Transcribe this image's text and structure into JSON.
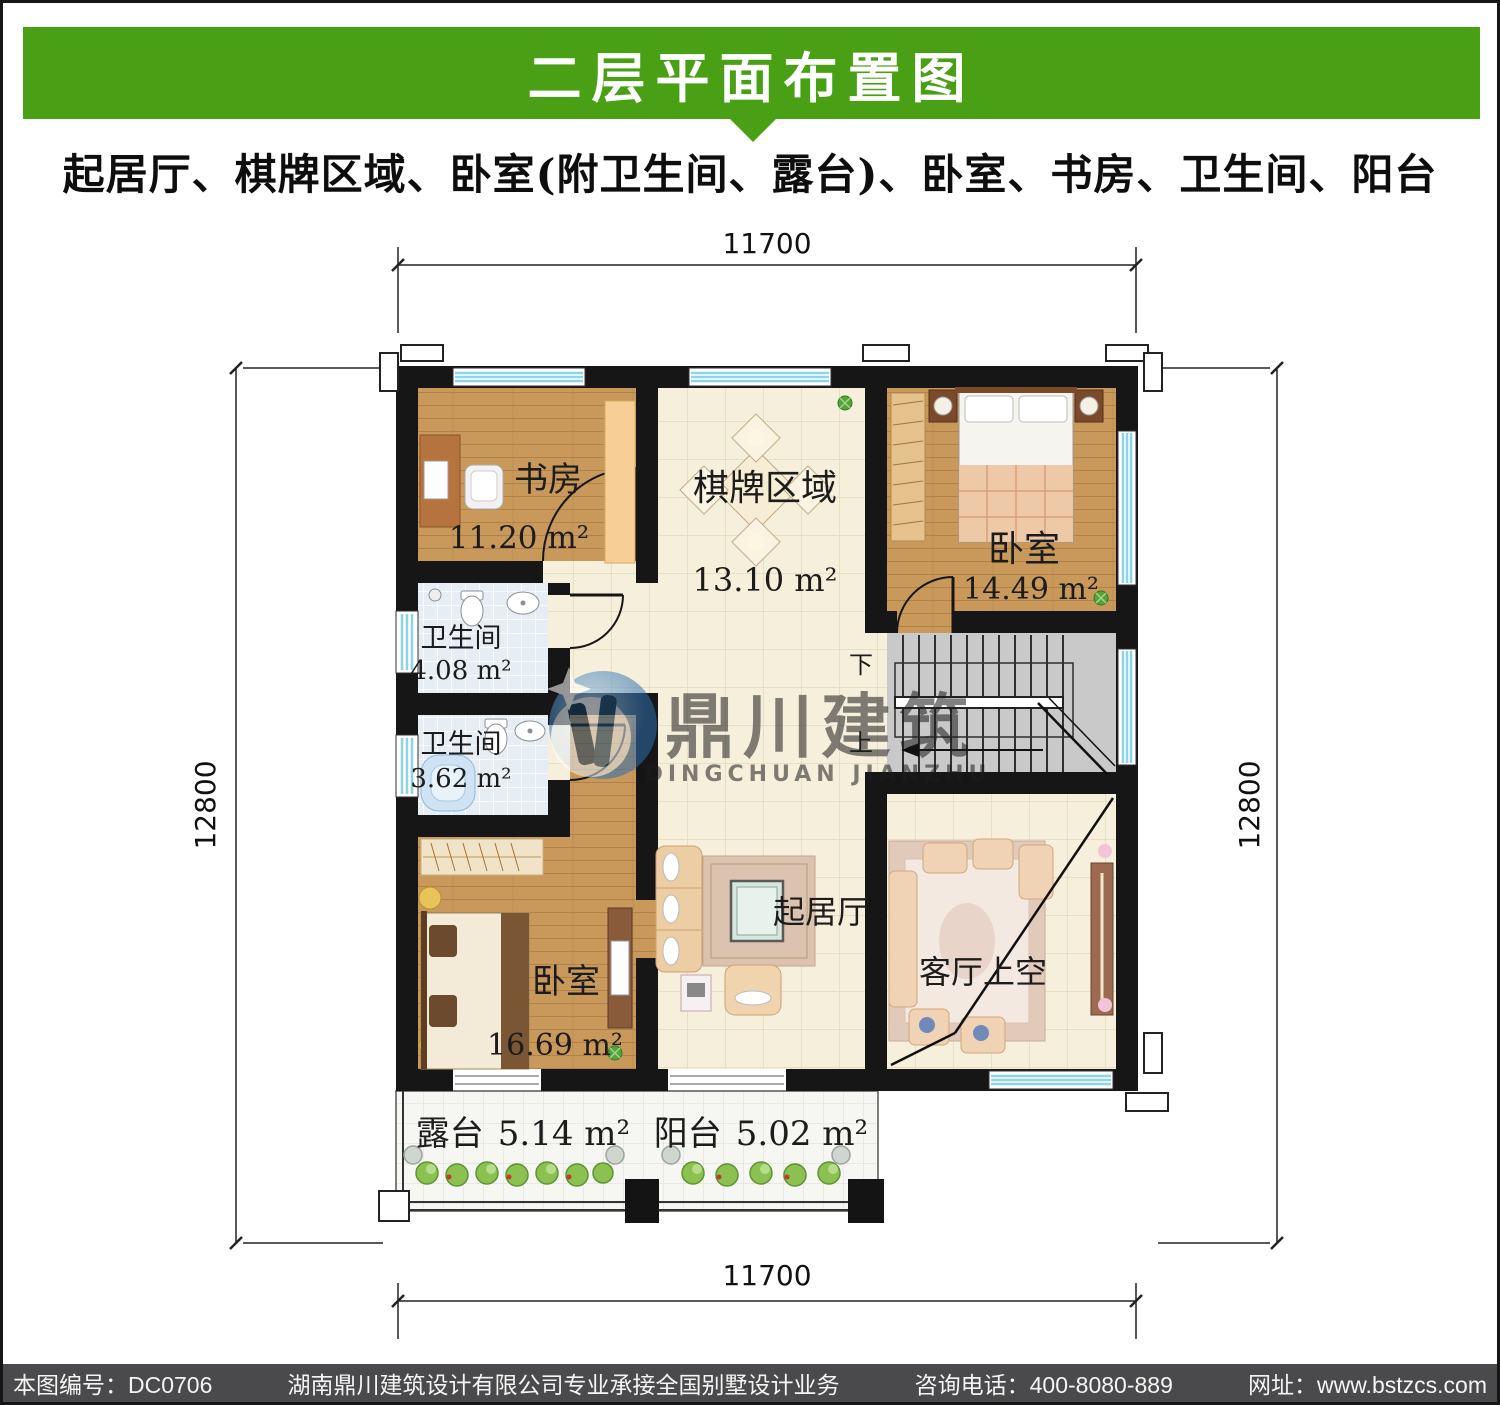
{
  "header": {
    "title": "二层平面布置图",
    "subtitle": "起居厅、棋牌区域、卧室(附卫生间、露台)、卧室、书房、卫生间、阳台"
  },
  "dims": {
    "top": "11700",
    "bottom": "11700",
    "left": "12800",
    "right": "12800"
  },
  "rooms": {
    "study": {
      "name": "书房",
      "area": "11.20 m²"
    },
    "chess": {
      "name": "棋牌区域",
      "area": "13.10 m²"
    },
    "bedroom_ne": {
      "name": "卧室",
      "area": "14.49 m²"
    },
    "bath_a": {
      "name": "卫生间",
      "area": "4.08 m²"
    },
    "bath_b": {
      "name": "卫生间",
      "area": "3.62 m²"
    },
    "bedroom_sw": {
      "name": "卧室",
      "area": "16.69 m²"
    },
    "living": {
      "name": "起居厅"
    },
    "void": {
      "name": "客厅上空"
    },
    "terrace": {
      "name": "露台",
      "area": "5.14 m²"
    },
    "balcony": {
      "name": "阳台",
      "area": "5.02 m²"
    }
  },
  "stairs": {
    "down": "下",
    "up": "上"
  },
  "watermark": {
    "cn": "鼎川建筑",
    "en": "DINGCHUAN JIANZHU"
  },
  "footer": {
    "code": "本图编号：DC0706",
    "company": "湖南鼎川建筑设计有限公司专业承接全国别墅设计业务",
    "phone": "咨询电话：400-8080-889",
    "website": "网址：www.bstzcs.com"
  },
  "colors": {
    "banner": "#4aa015",
    "footer_bar": "#4a4a4c",
    "wall": "#161616",
    "window_glass": "#8fd4e6",
    "wood_floor": "#c9995c",
    "tile_floor": "#f5efdc",
    "bath_floor": "#e7edf4",
    "stair_floor": "#c9c9c9",
    "watermark_blue": "#4a90c4"
  }
}
